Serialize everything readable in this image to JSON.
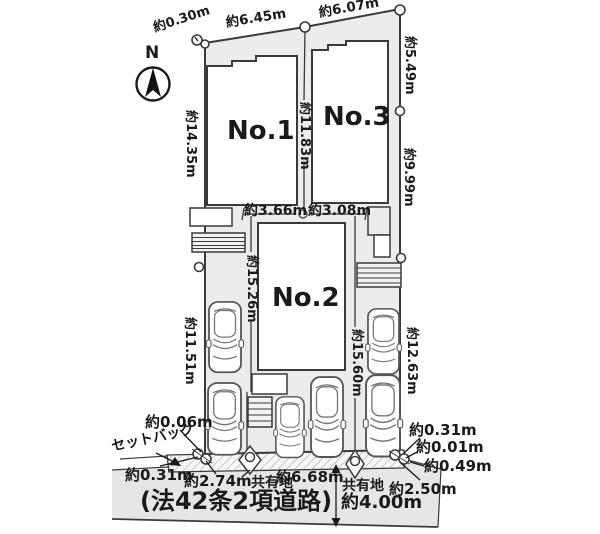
{
  "compass": {
    "north": "N"
  },
  "buildings": {
    "no1": "No.1",
    "no2": "No.2",
    "no3": "No.3"
  },
  "dims": {
    "top_offset": "約0.30m",
    "top_w1": "約6.45m",
    "top_w2": "約6.07m",
    "right_d1": "約5.49m",
    "right_d2": "約9.99m",
    "right_d3": "約12.63m",
    "left_d1": "約14.35m",
    "left_d2": "約11.51m",
    "mid_d": "約11.83m",
    "mid_w1": "約3.66m",
    "mid_w2": "約3.08m",
    "depth_left": "約15.26m",
    "depth_right": "約15.60m",
    "sw_o1": "約0.06m",
    "sw_o2": "約0.31m",
    "front_w1": "約2.74m",
    "front_w2": "約6.68m",
    "front_w3": "約2.50m",
    "se_o1": "約0.31m",
    "se_o2": "約0.01m",
    "se_o3": "約0.49m",
    "road_width": "約4.00m"
  },
  "labels": {
    "setback": "セットバック",
    "shared_left": "共有地",
    "shared_right": "共有地",
    "road_name": "(法42条2項道路)"
  },
  "colors": {
    "lot_fill": "#ececec",
    "road_fill": "#e6e6e6",
    "line": "#3a3a3a"
  }
}
